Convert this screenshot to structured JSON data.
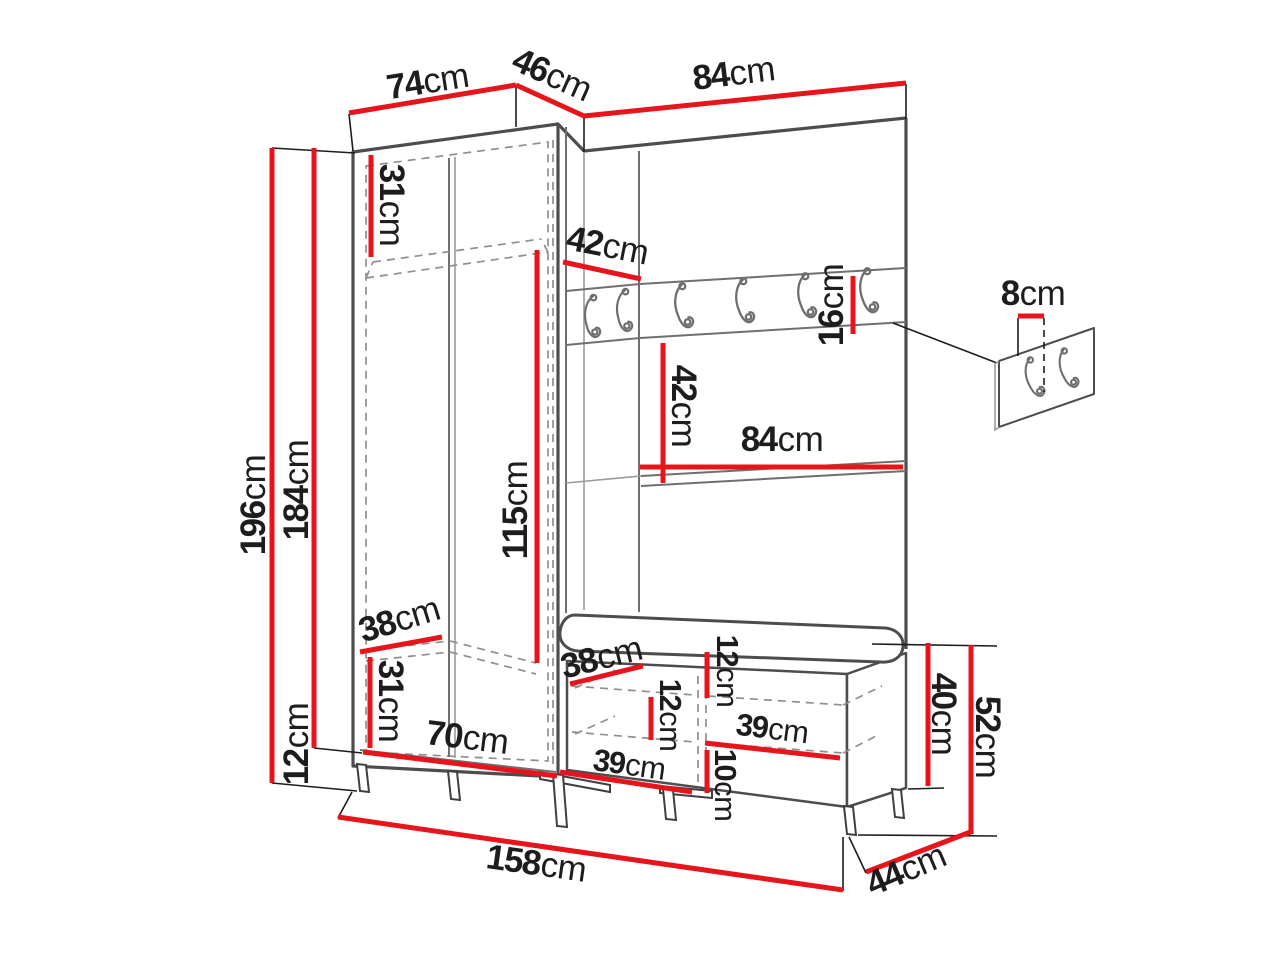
{
  "diagram": {
    "type": "furniture-dimension-drawing",
    "subject": "hallway wardrobe set with coat hook rail, wall hook panel and shoe bench",
    "accent_color": "#e8141c",
    "outline_color": "#4d4d4d",
    "text_color": "#1d1d1b",
    "hook_rail": {
      "hook_count": 6
    },
    "wall_hook_panel": {
      "hook_count": 2
    }
  },
  "dimensions": {
    "top_width_left": {
      "value": "74",
      "unit": "cm"
    },
    "top_width_corner": {
      "value": "46",
      "unit": "cm"
    },
    "top_width_right": {
      "value": "84",
      "unit": "cm"
    },
    "total_height": {
      "value": "196",
      "unit": "cm"
    },
    "cabinet_height": {
      "value": "184",
      "unit": "cm"
    },
    "leg_height": {
      "value": "12",
      "unit": "cm"
    },
    "top_compartment_height": {
      "value": "31",
      "unit": "cm"
    },
    "corner_shelf_depth": {
      "value": "42",
      "unit": "cm"
    },
    "interior_height": {
      "value": "115",
      "unit": "cm"
    },
    "hook_rail_height": {
      "value": "16",
      "unit": "cm"
    },
    "shelf_clearance": {
      "value": "42",
      "unit": "cm"
    },
    "panel_width": {
      "value": "84",
      "unit": "cm"
    },
    "wall_hook_offset": {
      "value": "8",
      "unit": "cm"
    },
    "shelf_depth": {
      "value": "38",
      "unit": "cm"
    },
    "bottom_compartment_height": {
      "value": "31",
      "unit": "cm"
    },
    "cabinet_inner_width": {
      "value": "70",
      "unit": "cm"
    },
    "bench_depth": {
      "value": "38",
      "unit": "cm"
    },
    "bench_upper_clearance": {
      "value": "12",
      "unit": "cm"
    },
    "bench_left_clearance": {
      "value": "12",
      "unit": "cm"
    },
    "bench_right_width": {
      "value": "39",
      "unit": "cm"
    },
    "bench_left_width": {
      "value": "39",
      "unit": "cm"
    },
    "bench_bottom_clearance": {
      "value": "10",
      "unit": "cm"
    },
    "bench_box_height": {
      "value": "40",
      "unit": "cm"
    },
    "bench_total_height": {
      "value": "52",
      "unit": "cm"
    },
    "total_width": {
      "value": "158",
      "unit": "cm"
    },
    "bench_side_depth": {
      "value": "44",
      "unit": "cm"
    }
  }
}
